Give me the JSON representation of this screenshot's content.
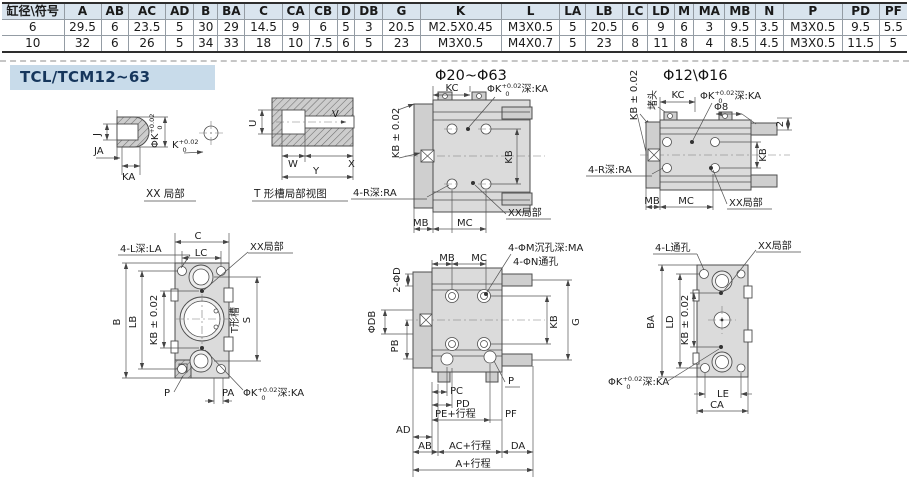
{
  "table": {
    "headers": [
      "缸径\\符号",
      "A",
      "AB",
      "AC",
      "AD",
      "B",
      "BA",
      "C",
      "CA",
      "CB",
      "D",
      "DB",
      "G",
      "K",
      "L",
      "LA",
      "LB",
      "LC",
      "LD",
      "M",
      "MA",
      "MB",
      "N",
      "P",
      "PD",
      "PF"
    ],
    "rows": [
      [
        "6",
        "29.5",
        "6",
        "23.5",
        "5",
        "30",
        "29",
        "14.5",
        "9",
        "6",
        "5",
        "3",
        "20.5",
        "M2.5X0.45",
        "M3X0.5",
        "5",
        "20.5",
        "6",
        "9",
        "6",
        "3",
        "9.5",
        "3.5",
        "M3X0.5",
        "9.5",
        "5.5"
      ],
      [
        "10",
        "32",
        "6",
        "26",
        "5",
        "34",
        "33",
        "18",
        "10",
        "7.5",
        "6",
        "5",
        "23",
        "M3X0.5",
        "M4X0.7",
        "5",
        "23",
        "8",
        "11",
        "8",
        "4",
        "8.5",
        "4.5",
        "M3X0.5",
        "11.5",
        "5"
      ]
    ]
  },
  "section_title": "TCL/TCM12~63",
  "tok": {
    "phik": "ΦK",
    "sup": "+0.02",
    "sub": "0",
    "depth_ka": "深:KA",
    "k": "K"
  },
  "drawings": {
    "detail_xx": {
      "caption": "XX 局部",
      "j": "J",
      "ja": "JA",
      "ka": "KA"
    },
    "tslot": {
      "caption": "T 形槽局部视图",
      "u": "U",
      "v": "V",
      "w": "W",
      "x": "X",
      "y": "Y"
    },
    "top_mid": {
      "title": "Φ20~Φ63",
      "kc": "KC",
      "kb_tol": "KB ± 0.02",
      "kb": "KB",
      "r_depth": "4-R深:RA",
      "mb": "MB",
      "mc": "MC",
      "xx": "XX局部"
    },
    "top_right": {
      "title": "Φ12\\Φ16",
      "kb_tol": "KB ± 0.02",
      "plug": "堵头",
      "kc": "KC",
      "phi8": "Φ8",
      "two": "2",
      "kb": "KB",
      "r_depth": "4-R深:RA",
      "mb": "MB",
      "mc": "MC",
      "xx": "XX局部"
    },
    "bot_left": {
      "l_depth": "4-L深:LA",
      "c": "C",
      "lc": "LC",
      "xx": "XX局部",
      "b": "B",
      "lb": "LB",
      "kb_tol": "KB ± 0.02",
      "s": "S",
      "tslot_label": "T形槽",
      "p": "P",
      "pa": "PA"
    },
    "bot_mid": {
      "mb": "MB",
      "mc": "MC",
      "m_hole": "4-ΦM沉孔深:MA",
      "n_hole": "4-ΦN通孔",
      "d2": "2-ΦD",
      "db": "ΦDB",
      "pb": "PB",
      "kb": "KB",
      "g": "G",
      "p": "P",
      "pc": "PC",
      "pd": "PD",
      "pe": "PE+行程",
      "pf": "PF",
      "ad": "AD",
      "ab": "AB",
      "ac": "AC+行程",
      "da": "DA",
      "a": "A+行程"
    },
    "bot_right": {
      "l_hole": "4-L通孔",
      "xx": "XX局部",
      "ba": "BA",
      "ld": "LD",
      "kb_tol": "KB ± 0.02",
      "le": "LE",
      "ca": "CA"
    }
  }
}
